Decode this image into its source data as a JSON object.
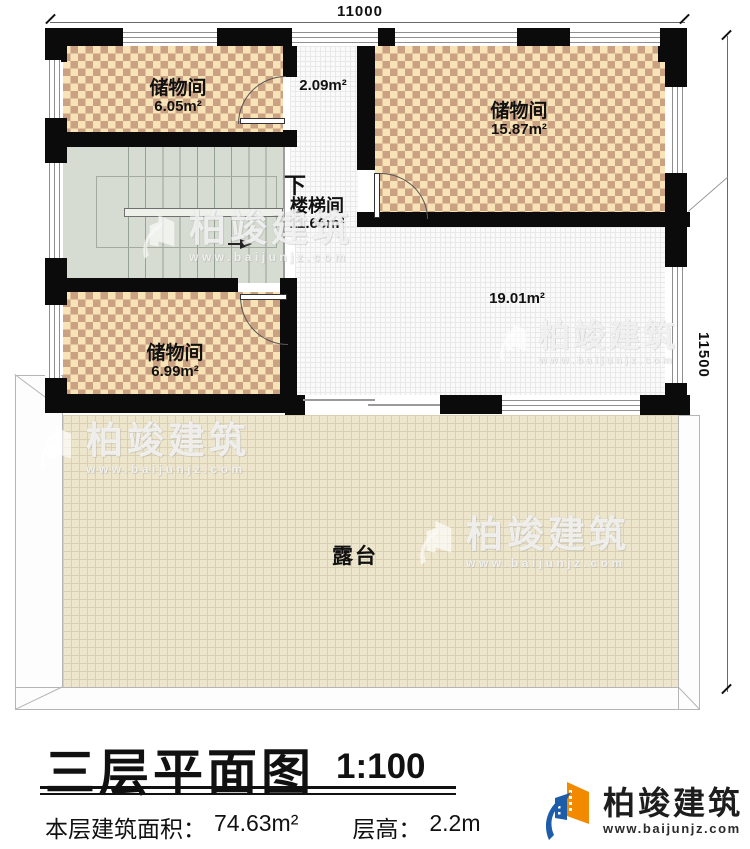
{
  "dimensions": {
    "top": "11000",
    "right": "11500"
  },
  "rooms": {
    "storage_top_left": {
      "name": "储物间",
      "area": "6.05m²"
    },
    "corridor": {
      "area": "2.09m²"
    },
    "storage_top_right": {
      "name": "储物间",
      "area": "15.87m²"
    },
    "stairwell": {
      "down_label": "下",
      "name": "楼梯间",
      "area": "11.66m²"
    },
    "storage_mid_left": {
      "name": "储物间",
      "area": "6.99m²"
    },
    "hall": {
      "area": "19.01m²"
    },
    "terrace": {
      "name": "露台"
    }
  },
  "title": {
    "main": "三层平面图",
    "scale": "1:100"
  },
  "info": {
    "area_label": "本层建筑面积：",
    "area_value": "74.63m²",
    "height_label": "层高：",
    "height_value": "2.2m"
  },
  "brand": {
    "name": "柏竣建筑",
    "url": "www.baijunjz.com"
  },
  "watermark": {
    "name": "柏竣建筑",
    "url": "www.baijunjz.com"
  },
  "icons": {
    "brand_logo": "building-swoosh-logo"
  },
  "colors": {
    "wall": "#0b0b0b",
    "checker_light": "#f7e3b5",
    "checker_dark": "#cba184",
    "terrace_fill": "#ede6cd",
    "stair_fill": "#d6dcd2",
    "logo_blue": "#1c5ca9",
    "logo_orange": "#f28a00"
  }
}
